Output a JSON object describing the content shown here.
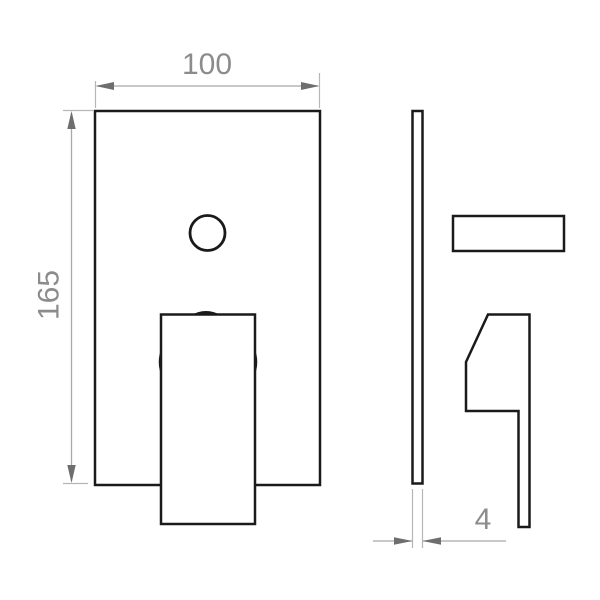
{
  "drawing": {
    "type": "technical-dimension-drawing",
    "subject": "concealed-mixer-valve-plate-with-lever-handle",
    "views": {
      "front": {
        "parts": [
          "wall-plate",
          "diverter-button",
          "lever-handle"
        ]
      },
      "side": {
        "parts": [
          "wall-plate-profile",
          "diverter-knob-profile",
          "lever-handle-profile"
        ]
      }
    },
    "dimensions": {
      "plate_width": {
        "value": "100"
      },
      "plate_height": {
        "value": "165"
      },
      "plate_thickness": {
        "value": "4"
      }
    },
    "colors": {
      "background": "#ffffff",
      "outline": "#1a1a1a",
      "dimension_line": "#a8a8a8",
      "extension_line": "#b6b6b6",
      "arrow": "#6e6e6e",
      "dimension_text": "#8c8c8c"
    }
  }
}
